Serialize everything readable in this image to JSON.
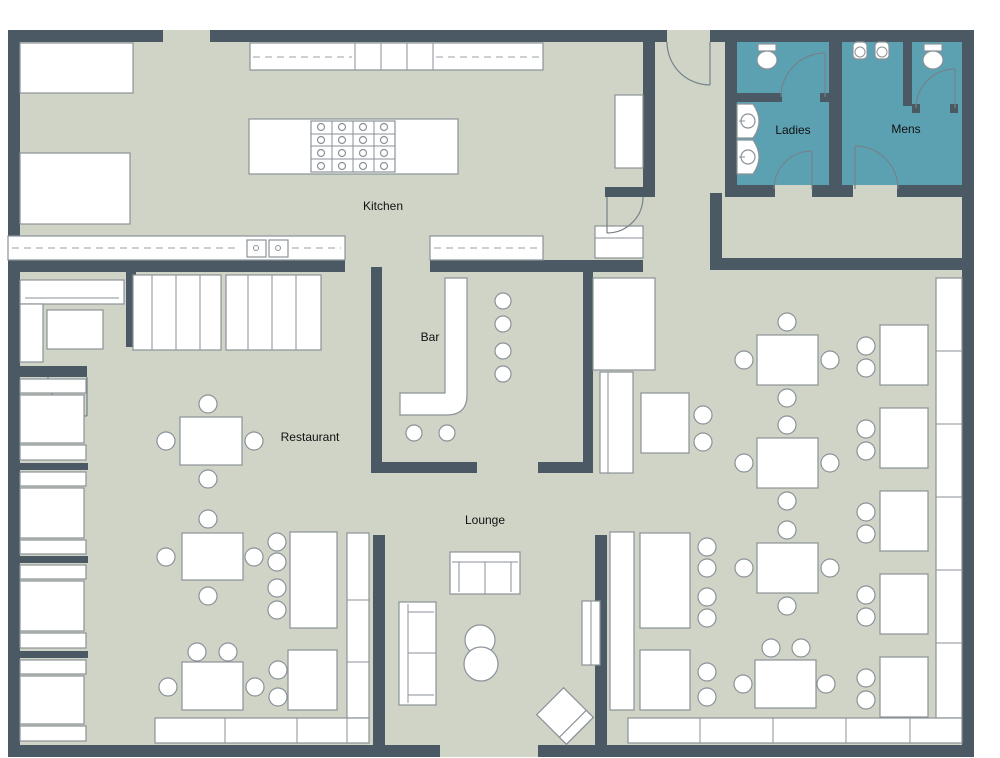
{
  "plan": {
    "title": "Restaurant floor plan",
    "rooms": {
      "kitchen": {
        "label": "Kitchen"
      },
      "ladies": {
        "label": "Ladies"
      },
      "mens": {
        "label": "Mens"
      },
      "bar": {
        "label": "Bar"
      },
      "restaurant": {
        "label": "Restaurant"
      },
      "lounge": {
        "label": "Lounge"
      }
    },
    "colors": {
      "wall": "#4a5963",
      "floor": "#cfd4c6",
      "restroom_floor": "#5ba1b2",
      "furniture_fill": "#ffffff",
      "furniture_stroke": "#8a9298",
      "background": "#ffffff",
      "label_text": "#111111"
    }
  }
}
